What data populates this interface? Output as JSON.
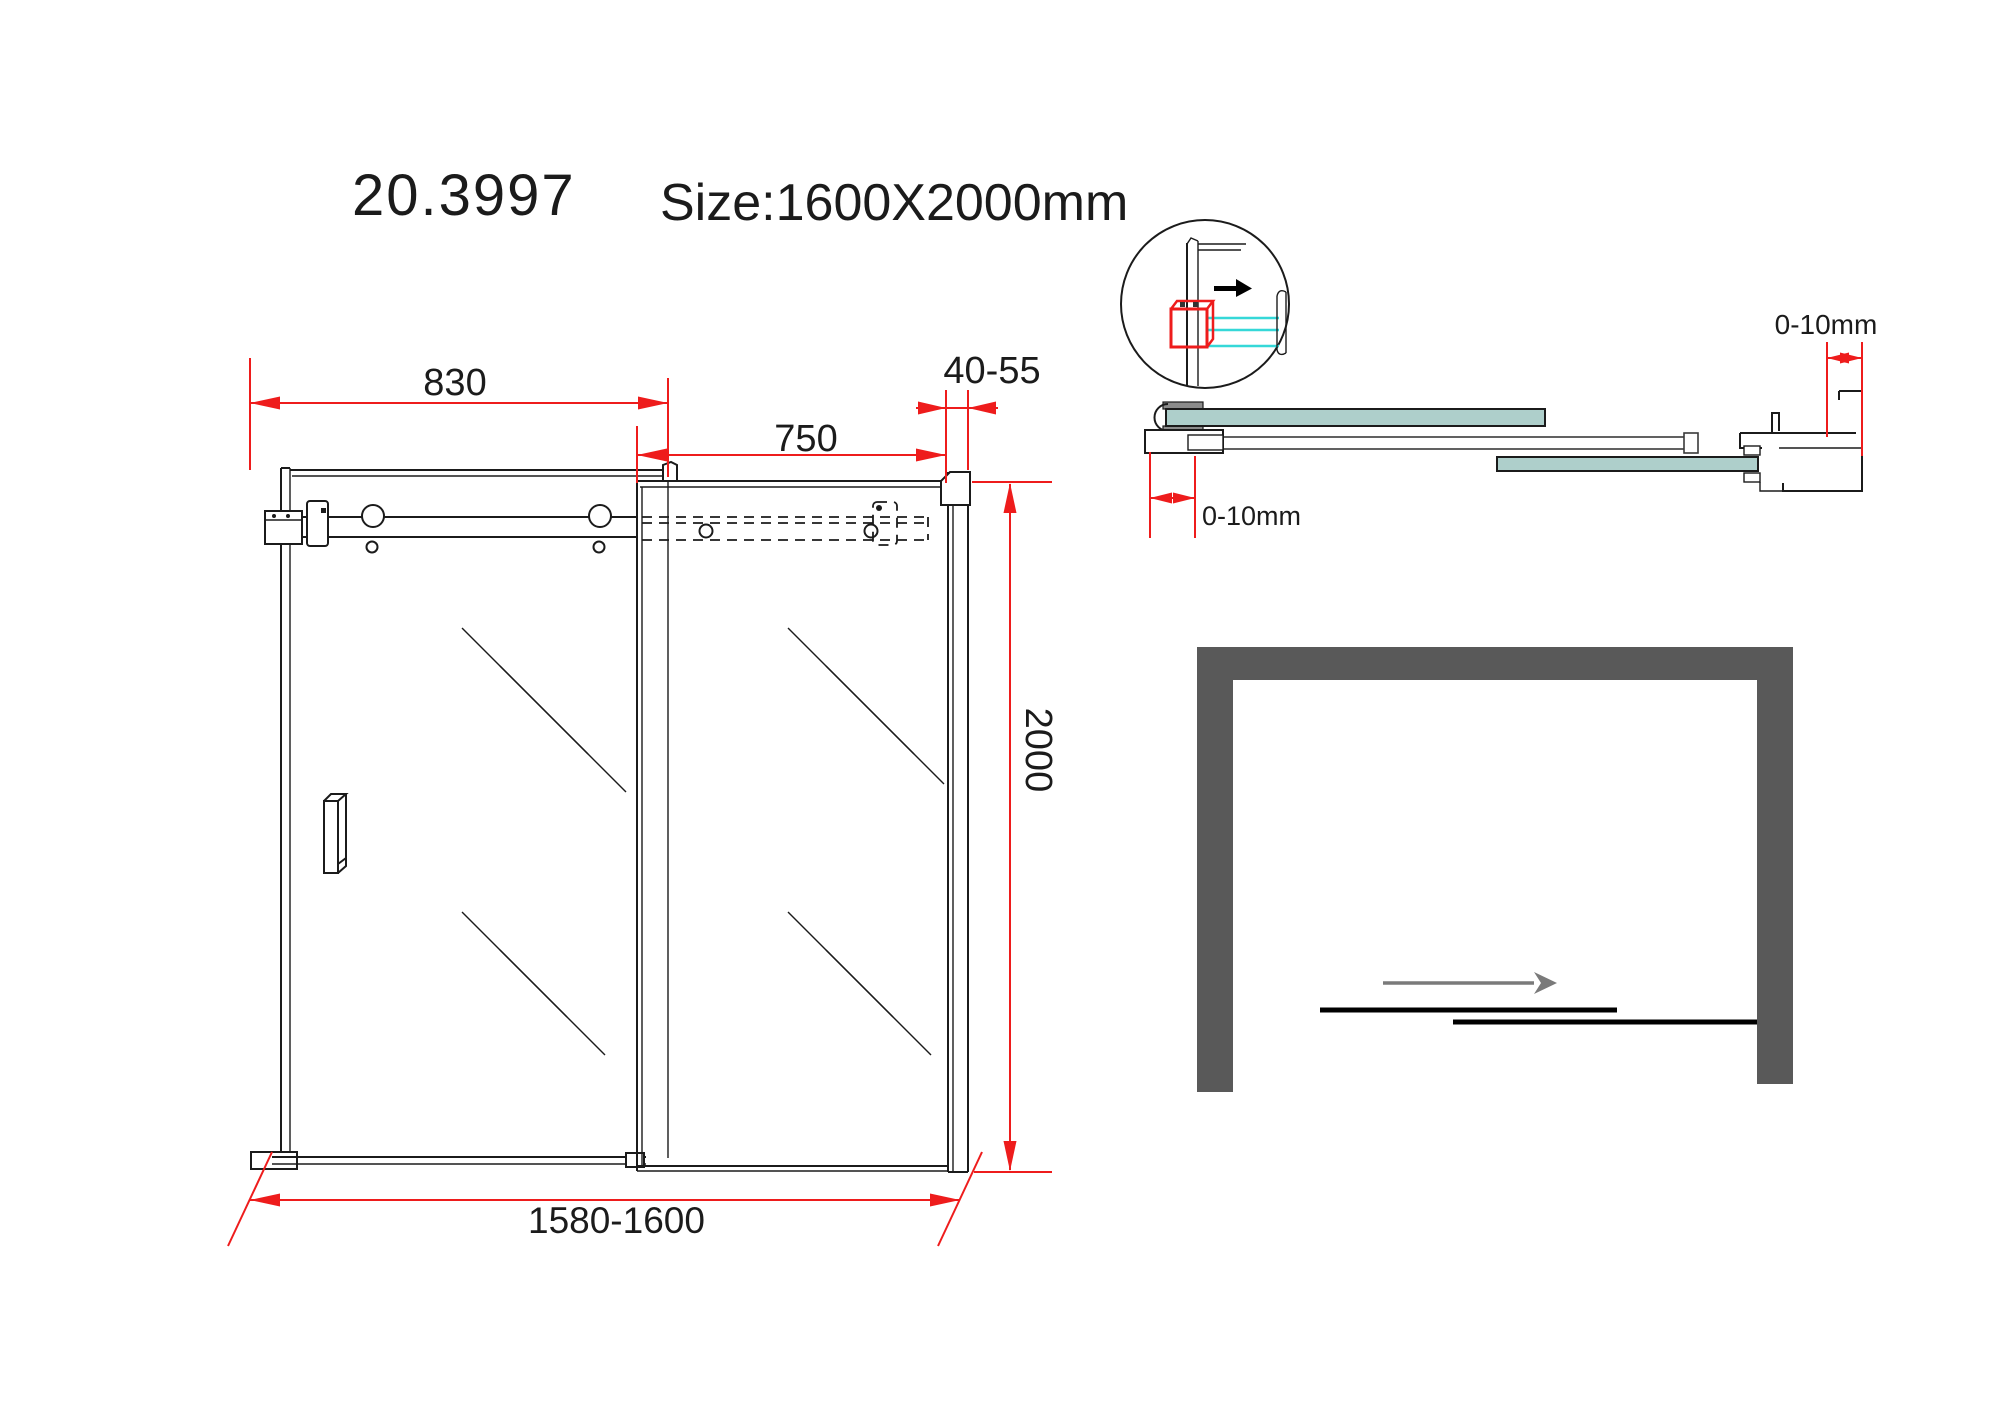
{
  "title": {
    "model": "20.3997",
    "size": "Size:1600X2000mm"
  },
  "front_elevation": {
    "dims": {
      "fixed_panel_width": "830",
      "door_panel_width": "750",
      "wall_profile_range": "40-55",
      "height": "2000",
      "overall_width": "1580-1600"
    }
  },
  "section_view": {
    "dims": {
      "bracket_adjustment": "0-10mm",
      "wall_profile_adjustment": "0-10mm"
    }
  },
  "plan_view": {
    "slide_direction": "right"
  },
  "icons": [
    {
      "name": "slide-direction-arrow-icon",
      "shape": "right-arrow-black"
    },
    {
      "name": "door-slide-arrow-icon",
      "shape": "right-arrow-gray"
    }
  ],
  "colors": {
    "dimension_red": "#ee1c1c",
    "glass_teal": "#aecfcb",
    "wall_gray": "#595959",
    "detail_cyan": "#35d8d8",
    "arrow_gray": "#7a7a7a",
    "line_black": "#1b1b1b"
  }
}
